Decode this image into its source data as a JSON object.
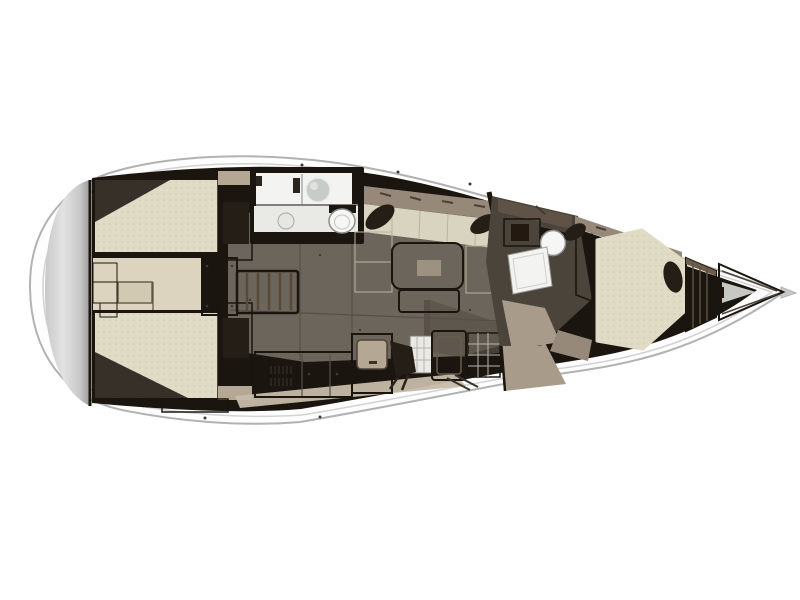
{
  "meta": {
    "title": "Sailing yacht interior layout — top-view floor plan render",
    "description": "3D rendered deck plan: rounded stern swim platform at left, two aft double cabins flanking a companionway corridor, aft head, central salon with U-settee and table, galley, forward head and forward V-berth cabin, wardrobe and anchor locker at the pointed bow (right)."
  },
  "palette": {
    "bg": "#ffffff",
    "hull_fill": "#fdfdfd",
    "hull_stroke": "#b2b2b2",
    "deck_line": "#d2d2d2",
    "transom_light": "#e2e2e2",
    "transom_mid": "#c8c8c8",
    "transom_dark": "#9b9b9b",
    "wall": "#1b1510",
    "floor": "#6c655c",
    "floor_dark": "#595149",
    "seam": "#b7b29e",
    "seam_dark": "#554f47",
    "mattress": "#e0dbc4",
    "cushion": "#d9d4c0",
    "corridor": "#dcd4be",
    "hatch_fill": "#d2c9b3",
    "steps": "#c1b39b",
    "ridge": "#584a38",
    "taupe": "#97897a",
    "taupe_light": "#b4a793",
    "counter": "#8b8073",
    "table": "#cfc2b7",
    "table_center": "#9d9182",
    "white_room": "#f3f3f1",
    "white_soft": "#e9e9e6",
    "fixture": "#f6f6f4",
    "sink": "#c8ccc8",
    "pillow": "#241e16",
    "wood": "#3f3426",
    "wood_light": "#6e5d49",
    "ramp": "#a89b8a",
    "head_floor": "#4b443b",
    "head_shelf": "#5e5346",
    "door_band": "#b2a592",
    "locker": "#ededeb",
    "locker_gray": "#c7c7c4",
    "shadow": "#17120d",
    "deck_strip": "#c6bba8",
    "grid_line": "#b9b6aa",
    "slat": "#5d4e3c",
    "hardware": "#3f3a33",
    "dark_detail": "#2a251e"
  },
  "regions": {
    "hull": {
      "label": "Hull — top view"
    },
    "swim_platform": {
      "label": "Stern swim platform"
    },
    "aft_cabin_port": {
      "label": "Aft cabin (top) — double berth"
    },
    "aft_cabin_starboard": {
      "label": "Aft cabin (bottom) — double berth"
    },
    "aft_corridor": {
      "label": "Aft corridor under cockpit"
    },
    "companionway": {
      "label": "Companionway steps"
    },
    "aft_head": {
      "label": "Aft head with sink and toilet"
    },
    "salon": {
      "label": "Salon sole"
    },
    "settee": {
      "label": "Salon settee with cushions"
    },
    "table": {
      "label": "Salon table"
    },
    "galley": {
      "label": "Galley with counters, fridge and stove"
    },
    "forward_head": {
      "label": "Forward head with shower, sink and toilet"
    },
    "forward_cabin": {
      "label": "Forward cabin — V-berth"
    },
    "wardrobe": {
      "label": "Wardrobe shelves"
    },
    "anchor_locker": {
      "label": "Anchor locker"
    }
  }
}
